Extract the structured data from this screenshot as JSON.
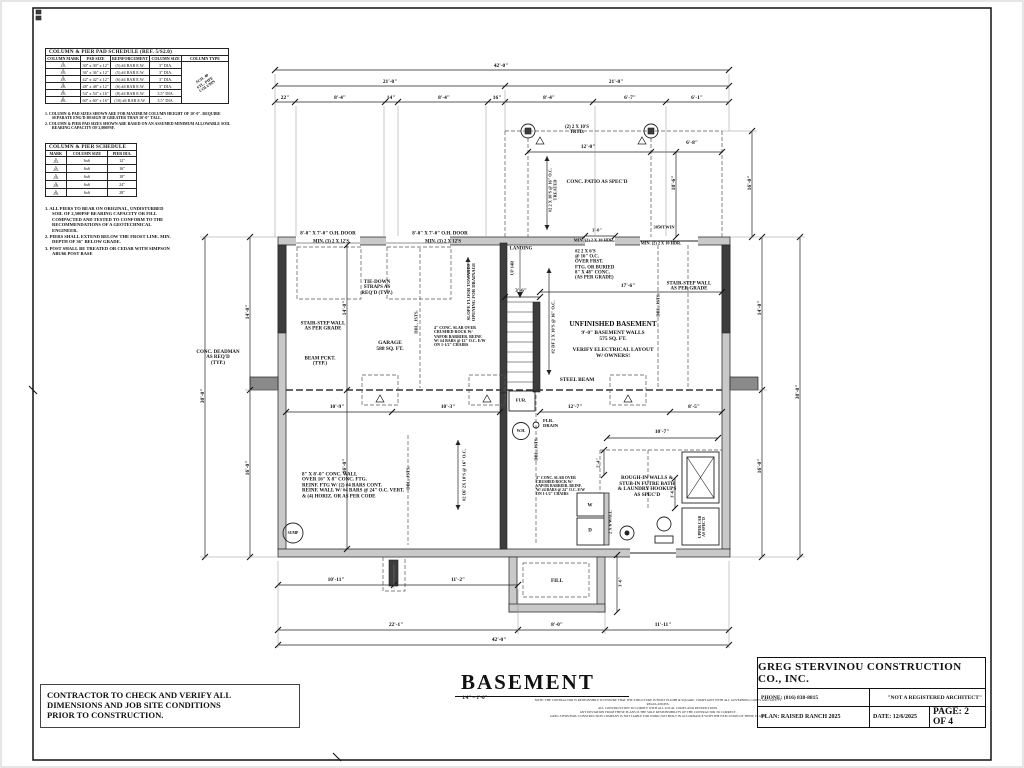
{
  "pad_schedule": {
    "title": "COLUMN & PIER PAD SCHEDULE (REF. 5/S2.0)",
    "headers": [
      "COLUMN MARK",
      "PAD SIZE",
      "REINFORCEMENT",
      "COLUMN SIZE",
      "COLUMN TYPE"
    ],
    "rows": [
      {
        "mark": "1",
        "pad": "30\" x 30\" x 12\"",
        "reinf": "(5) #4 BAR E.W.",
        "col": "3\" DIA."
      },
      {
        "mark": "2",
        "pad": "36\" x 36\" x 12\"",
        "reinf": "(5) #4 BAR E.W.",
        "col": "3\" DIA."
      },
      {
        "mark": "3",
        "pad": "42\" x 42\" x 12\"",
        "reinf": "(6) #4 BAR E.W.",
        "col": "3\" DIA."
      },
      {
        "mark": "4",
        "pad": "48\" x 48\" x 12\"",
        "reinf": "(6) #4 BAR E.W.",
        "col": "3\" DIA."
      },
      {
        "mark": "5",
        "pad": "54\" x 54\" x 16\"",
        "reinf": "(8) #4 BAR E.W.",
        "col": "3.5\" DIA."
      },
      {
        "mark": "6",
        "pad": "60\" x 60\" x 16\"",
        "reinf": "(10) #4 BAR E.W.",
        "col": "3.5\" DIA."
      }
    ],
    "column_type_note": [
      "SCH. 40",
      "STL. PIPE",
      "COLUMN"
    ],
    "notes": [
      "1. COLUMN & PAD SIZES SHOWN ARE FOR MAXIMUM COLUMN HEIGHT OF 10'-0\". REQUIRE SEPARATE ENG'D DESIGN IF GREATER THAN 10'-0\" TALL.",
      "2. COLUMN & PIER PAD SIZES SHOWN ARE BASED ON AN ASSUMED MINIMUM ALLOWABLE SOIL BEARING CAPACITY OF 2,000PSF."
    ]
  },
  "pier_schedule": {
    "title": "COLUMN & PIER SCHEDULE",
    "headers": [
      "MARK",
      "COLUMN SIZE",
      "PIER DIA."
    ],
    "rows": [
      {
        "mark": "1",
        "col": "6x6",
        "dia": "12\""
      },
      {
        "mark": "2",
        "col": "6x6",
        "dia": "16\""
      },
      {
        "mark": "3",
        "col": "6x6",
        "dia": "18\""
      },
      {
        "mark": "4",
        "col": "6x6",
        "dia": "24\""
      },
      {
        "mark": "5",
        "col": "6x6",
        "dia": "28\""
      }
    ],
    "notes": [
      "1. ALL PIERS TO BEAR ON ORIGINAL, UNDISTURBED SOIL OF 2,500PSF BEARING CAPACITY OR FILL COMPACTED AND TESTED TO CONFORM TO THE RECOMMENDATIONS OF A GEOTECHNICAL ENGINEER.",
      "2. PIERS SHALL EXTEND BELOW THE FROST LINE. MIN. DEPTH OF 36\" BELOW GRADE.",
      "3. POST SHALL BE TREATED OR CEDAR WITH SIMPSON ABU66 POST BASE"
    ]
  },
  "plan": {
    "title": "BASEMENT",
    "scale": "1/4\" = 1'-0\"",
    "labels": [
      {
        "t": "42'-0\"",
        "x": 501,
        "y": 67
      },
      {
        "t": "21'-0\"",
        "x": 390,
        "y": 83
      },
      {
        "t": "21'-0\"",
        "x": 616,
        "y": 83
      },
      {
        "t": "22\"",
        "x": 285,
        "y": 99
      },
      {
        "t": "8'-4\"",
        "x": 340,
        "y": 99
      },
      {
        "t": "14\"",
        "x": 391,
        "y": 99
      },
      {
        "t": "8'-4\"",
        "x": 444,
        "y": 99
      },
      {
        "t": "16\"",
        "x": 497,
        "y": 99
      },
      {
        "t": "8'-4\"",
        "x": 549,
        "y": 99
      },
      {
        "t": "6'-7\"",
        "x": 630,
        "y": 99
      },
      {
        "t": "6'-1\"",
        "x": 697,
        "y": 99
      },
      {
        "t": "30'-0\"",
        "x": 204,
        "y": 396,
        "r": -90
      },
      {
        "t": "14'-0\"",
        "x": 249,
        "y": 312,
        "r": -90
      },
      {
        "t": "16'-0\"",
        "x": 249,
        "y": 468,
        "r": -90
      },
      {
        "t": "14'-0\"",
        "x": 346,
        "y": 308,
        "r": -90
      },
      {
        "t": "16'-0\"",
        "x": 346,
        "y": 466,
        "r": -90
      },
      {
        "t": "30'-0\"",
        "x": 799,
        "y": 392,
        "r": -90
      },
      {
        "t": "14'-0\"",
        "x": 761,
        "y": 308,
        "r": -90
      },
      {
        "t": "16'-0\"",
        "x": 761,
        "y": 466,
        "r": -90
      },
      {
        "t": "16'-0\"",
        "x": 751,
        "y": 183,
        "r": -90
      },
      {
        "t": "10'-6\"",
        "x": 675,
        "y": 183,
        "r": -90
      },
      {
        "t": "12'-0\"",
        "x": 588,
        "y": 148
      },
      {
        "t": "6'-8\"",
        "x": 692,
        "y": 144
      },
      {
        "t": "10'-9\"",
        "x": 337,
        "y": 408
      },
      {
        "t": "10'-3\"",
        "x": 448,
        "y": 408
      },
      {
        "t": "12'-7\"",
        "x": 575,
        "y": 408
      },
      {
        "t": "8'-5\"",
        "x": 694,
        "y": 408
      },
      {
        "t": "10'-7\"",
        "x": 662,
        "y": 433
      },
      {
        "t": "17'-6\"",
        "x": 628,
        "y": 287
      },
      {
        "t": "3'-6\"",
        "x": 521,
        "y": 292
      },
      {
        "t": "3'-0\"",
        "x": 597,
        "y": 231,
        "fs": 4.5
      },
      {
        "t": "2'-4\"",
        "x": 599,
        "y": 463,
        "r": -90,
        "fs": 4.5
      },
      {
        "t": "3'-6\"",
        "x": 673,
        "y": 493,
        "r": -90,
        "fs": 4.5
      },
      {
        "t": "10'-11\"",
        "x": 336,
        "y": 581
      },
      {
        "t": "11'-2\"",
        "x": 458,
        "y": 581
      },
      {
        "t": "3'-6\"",
        "x": 621,
        "y": 582,
        "r": -90,
        "fs": 4.5
      },
      {
        "t": "22'-1\"",
        "x": 396,
        "y": 626
      },
      {
        "t": "8'-0\"",
        "x": 557,
        "y": 626
      },
      {
        "t": "11'-11\"",
        "x": 663,
        "y": 626
      },
      {
        "t": "42'-0\"",
        "x": 499,
        "y": 641
      },
      {
        "t": "8'-0\" X 7'-0\" O.H. DOOR",
        "x": 328,
        "y": 234,
        "fs": 5,
        "n": "annotation"
      },
      {
        "t": "MIN. (3) 2 X 12'S",
        "x": 331,
        "y": 242,
        "fs": 4.8,
        "n": "annotation"
      },
      {
        "t": "8'-0\" X 7'-0\" O.H. DOOR",
        "x": 440,
        "y": 234,
        "fs": 5,
        "n": "annotation"
      },
      {
        "t": "MIN. (3) 2 X 12'S",
        "x": 443,
        "y": 242,
        "fs": 4.8,
        "n": "annotation"
      },
      {
        "lines": [
          "TIE-DOWN",
          "STRAPS AS",
          "REQ'D (TYP.)"
        ],
        "x": 377,
        "y": 288,
        "fs": 5,
        "n": "annotation"
      },
      {
        "lines": [
          "STAIR-STEP WALL",
          "AS PER GRADE"
        ],
        "x": 323,
        "y": 327,
        "fs": 5,
        "n": "annotation"
      },
      {
        "lines": [
          "BEAM PCKT.",
          "(TYP.)"
        ],
        "x": 320,
        "y": 362,
        "fs": 5,
        "n": "annotation"
      },
      {
        "lines": [
          "GARAGE",
          "588 SQ. FT."
        ],
        "x": 390,
        "y": 347,
        "fs": 5.4,
        "n": "annotation"
      },
      {
        "t": "DBL. JSTS.",
        "x": 417,
        "y": 322,
        "r": -90,
        "fs": 4.6,
        "n": "annotation"
      },
      {
        "lines": [
          "SLOPE FLOOR TOWARDS",
          "OPENING FOR DRAINAGE"
        ],
        "x": 472,
        "y": 292,
        "r": -90,
        "fs": 4.6,
        "n": "annotation"
      },
      {
        "lines": [
          "4\" CONC. SLAB OVER",
          "CRUSHED ROCK W/",
          "VAPOR BARRIER. REINF.",
          "W/ #4 BARS @ 12\" O.C. E/W",
          "ON 1-1/2\" CHAIRS"
        ],
        "x": 434,
        "y": 337,
        "fs": 4,
        "al": "left",
        "n": "annotation"
      },
      {
        "t": "LANDING",
        "x": 521,
        "y": 249,
        "fs": 4.8,
        "n": "annotation"
      },
      {
        "t": "UP 14R",
        "x": 513,
        "y": 268,
        "r": -90,
        "fs": 4.4,
        "n": "annotation"
      },
      {
        "t": "#2 DF 2 X 10'S @ 16\" O.C.",
        "x": 554,
        "y": 327,
        "r": -90,
        "fs": 4.6,
        "n": "annotation"
      },
      {
        "lines": [
          "#2 2 X 6'S",
          "@ 16\" O.C.",
          "OVER FRST.",
          "FTG. OR BURIED",
          "8\" X 48\" CONC.",
          "(AS PER GRADE)"
        ],
        "x": 575,
        "y": 265,
        "fs": 4.8,
        "al": "left",
        "n": "annotation"
      },
      {
        "t": "MIN. (2) 2 X 10 HDR.",
        "x": 594,
        "y": 241,
        "fs": 4.3,
        "n": "annotation"
      },
      {
        "t": "MIN. (2) 2 X 10 HDR.",
        "x": 661,
        "y": 244,
        "fs": 4.3,
        "n": "annotation"
      },
      {
        "t": "3050TWIN",
        "x": 664,
        "y": 228,
        "fs": 4.4,
        "n": "annotation"
      },
      {
        "lines": [
          "STAIR-STEP WALL",
          "AS PER GRADE"
        ],
        "x": 689,
        "y": 287,
        "fs": 5,
        "n": "annotation"
      },
      {
        "t": "DBL. JSTS.",
        "x": 659,
        "y": 305,
        "r": -90,
        "fs": 4.6,
        "n": "annotation"
      },
      {
        "t": "UNFINISHED BASEMENT",
        "x": 613,
        "y": 325,
        "fs": 7.2,
        "n": "annotation"
      },
      {
        "lines": [
          "9'-0\" BASEMENT WALLS",
          "575 SQ. FT."
        ],
        "x": 613,
        "y": 337,
        "fs": 5.4,
        "n": "annotation"
      },
      {
        "lines": [
          "VERIFY ELECTRICAL LAYOUT",
          "W/ OWNERS!"
        ],
        "x": 613,
        "y": 354,
        "fs": 5.4,
        "n": "annotation"
      },
      {
        "t": "STEEL BEAM",
        "x": 577,
        "y": 381,
        "fs": 5.4,
        "n": "annotation"
      },
      {
        "t": "FUR.",
        "x": 521,
        "y": 401,
        "fs": 4.6,
        "n": "annotation"
      },
      {
        "t": "W.H.",
        "x": 521,
        "y": 431,
        "fs": 4,
        "n": "annotation"
      },
      {
        "lines": [
          "FLR.",
          "DRAIN"
        ],
        "x": 543,
        "y": 424,
        "fs": 4.6,
        "al": "left",
        "n": "annotation"
      },
      {
        "t": "DBL. JSTS.",
        "x": 537,
        "y": 449,
        "r": -90,
        "fs": 4.6,
        "n": "annotation"
      },
      {
        "t": "#2 DF 2X 10'S @ 16\" O.C.",
        "x": 465,
        "y": 475,
        "r": -90,
        "fs": 4.6,
        "n": "annotation"
      },
      {
        "t": "DBL. JSTS.",
        "x": 409,
        "y": 478,
        "r": -90,
        "fs": 4.6,
        "n": "annotation"
      },
      {
        "lines": [
          "8\" X 8'-0\" CONC. WALL",
          "OVER 16\" X 8\" CONC. FTG.",
          "REINF. FTG W/ (2) #4 BARS CONT.",
          "REINF. WALL W/ #4 BARS @ 24\" O.C. VERT.",
          "& (4) HORIZ. OR AS PER CODE"
        ],
        "x": 302,
        "y": 486,
        "fs": 5,
        "al": "left",
        "n": "annotation"
      },
      {
        "t": "SUMP",
        "x": 293,
        "y": 533,
        "fs": 3.8,
        "n": "annotation"
      },
      {
        "lines": [
          "4\" CONC. SLAB OVER",
          "CRUSHED ROCK W/",
          "VAPOR BARRIER. REINF.",
          "W/ #4 BARS @ 24\" O.C. E/W",
          "ON 1-1/2\" CHAIRS"
        ],
        "x": 536,
        "y": 486,
        "fs": 3.8,
        "al": "left",
        "n": "annotation"
      },
      {
        "lines": [
          "ROUGH-IN WALLS &",
          "STUB-IN FUTRE BATH",
          "& LAUNDRY HOOKUPS",
          "AS SPEC'D"
        ],
        "x": 647,
        "y": 487,
        "fs": 5.2,
        "n": "annotation"
      },
      {
        "t": "2 X 6 WALL",
        "x": 611,
        "y": 522,
        "r": -90,
        "fs": 4.4,
        "n": "annotation"
      },
      {
        "t": "W",
        "x": 590,
        "y": 506,
        "fs": 5,
        "n": "annotation"
      },
      {
        "t": "D",
        "x": 590,
        "y": 531,
        "fs": 5,
        "n": "annotation"
      },
      {
        "lines": [
          "UPPER CAB",
          "AS SPEC'D"
        ],
        "x": 702,
        "y": 527,
        "r": -90,
        "fs": 3.9,
        "n": "annotation"
      },
      {
        "lines": [
          "(2) 2 X 10'S",
          "TRTD."
        ],
        "x": 577,
        "y": 130,
        "fs": 4.8,
        "n": "annotation"
      },
      {
        "lines": [
          "#2 2 X 10'S @ 16\" O.C.",
          "TREATED"
        ],
        "x": 553,
        "y": 190,
        "r": -90,
        "fs": 4.4,
        "n": "annotation"
      },
      {
        "t": "CONC. PATIO AS SPEC'D",
        "x": 597,
        "y": 183,
        "fs": 5.2,
        "n": "annotation"
      },
      {
        "lines": [
          "CONC. DEADMAN",
          "AS REQ'D",
          "(TYP.)"
        ],
        "x": 218,
        "y": 358,
        "fs": 5,
        "n": "annotation"
      },
      {
        "t": "FILL",
        "x": 557,
        "y": 582,
        "fs": 5.2,
        "n": "annotation"
      }
    ]
  },
  "footer": {
    "disclaimer": [
      "NOTE: THE CONTRACTOR IS RESPONSIBLE TO ENSURE THAT THE STRUCTURE IS BUILT PLUMB & SQUARE, COMPLIANT WITH ALL GOVERNING CODES AND SAFETY REGULATIONS.",
      "ALL CONSTRUCTION TO COMPLY WITH ALL LOCAL CODES AND RESTRICTIONS.",
      "ANY DEVIATION FROM THESE PLANS IS THE SOLE RESPONSIBILITY OF THE CONTRACTOR TO CORRECT.",
      "GREG STERVINOU CONSTRUCTION COMPANY IS NOT LIABLE FOR WORK NOT BUILT IN ACCORDANCE WITH THE EXECUTION OF THESE PLANS."
    ]
  },
  "contractor_note": {
    "line1": "CONTRACTOR TO CHECK AND VERIFY ALL",
    "line2": "DIMENSIONS AND JOB SITE CONDITIONS",
    "line3": "PRIOR TO CONSTRUCTION."
  },
  "title_block": {
    "company": "GREG STERVINOU CONSTRUCTION CO., INC.",
    "phone": "PHONE: (816) 838-8815",
    "architect_note": "\"NOT A REGISTERED ARCHITECT\"",
    "plan": "PLAN: RAISED RANCH 2025",
    "date": "DATE: 12/6/2025",
    "page": "PAGE: 2 OF 4"
  }
}
